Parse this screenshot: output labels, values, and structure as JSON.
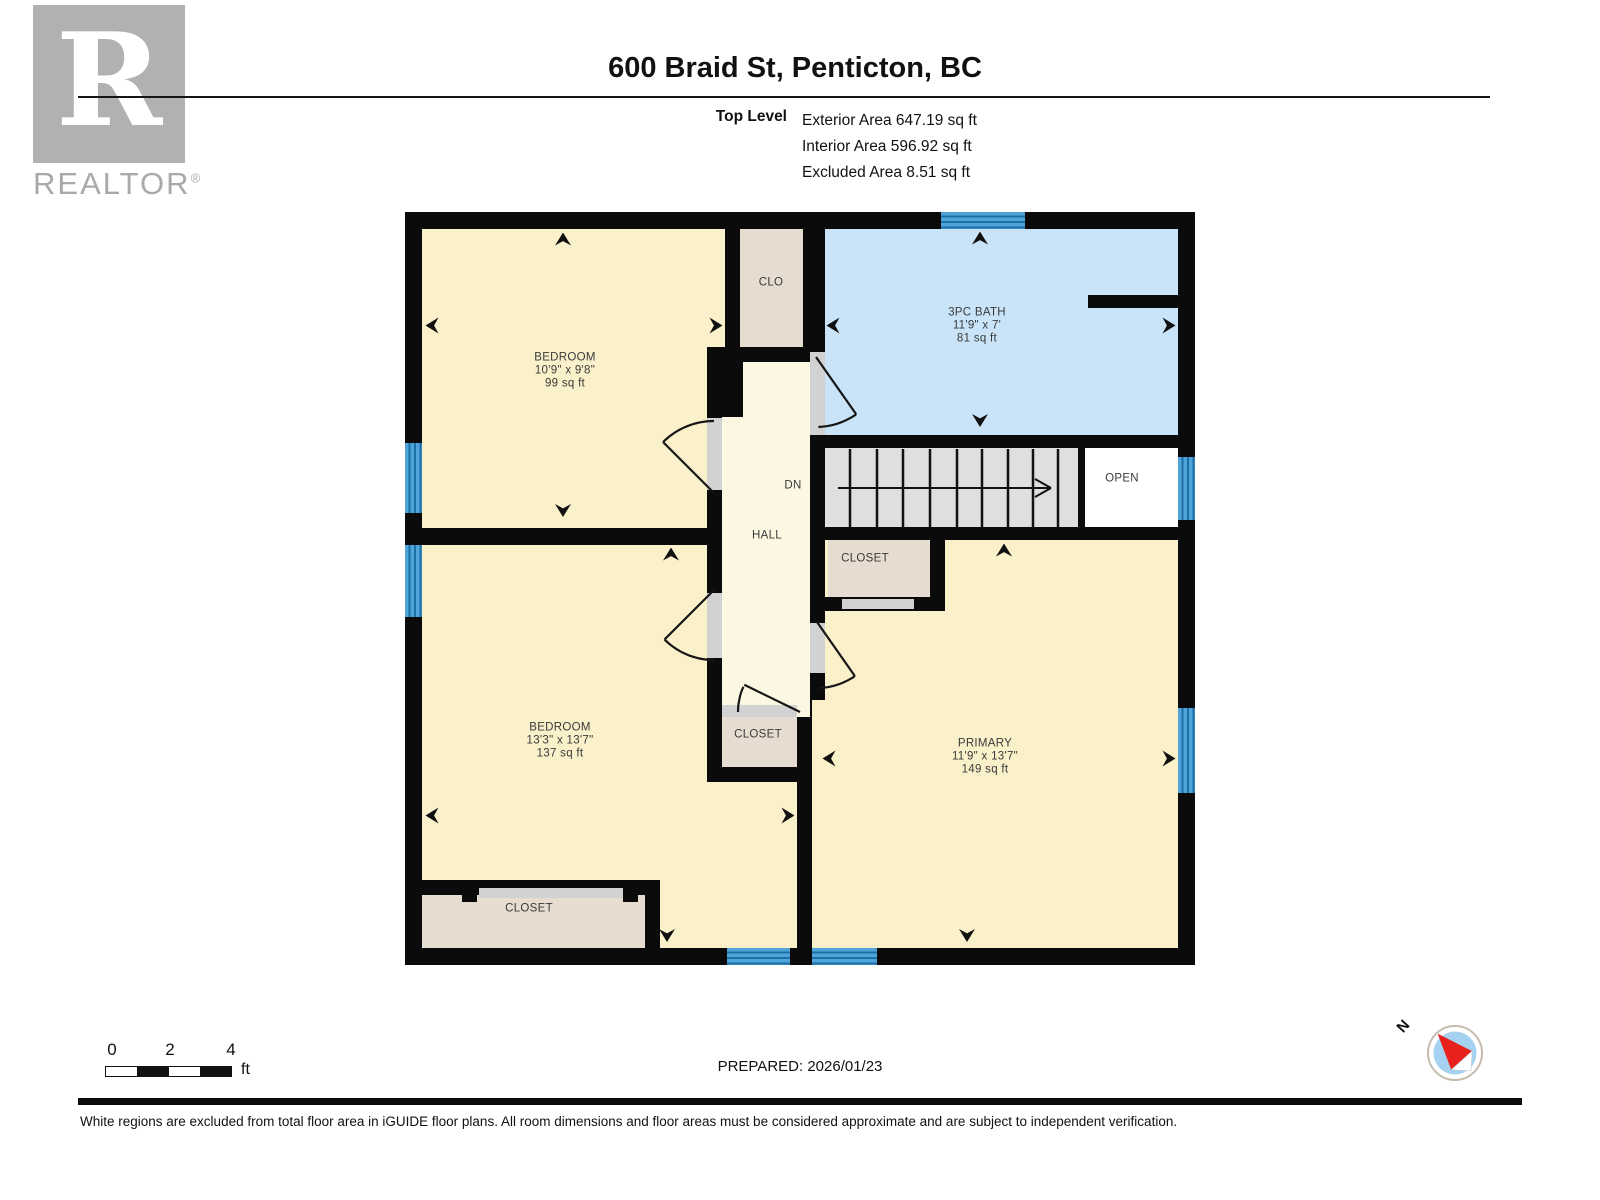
{
  "header": {
    "title": "600 Braid St, Penticton, BC",
    "level_label": "Top Level",
    "stats": [
      "Exterior Area 647.19 sq ft",
      "Interior Area 596.92 sq ft",
      "Excluded Area 8.51 sq ft"
    ]
  },
  "branding": {
    "logo_letter": "R",
    "logo_text": "REALTOR",
    "registered": "®"
  },
  "rooms": [
    {
      "name": "BEDROOM",
      "dims": "10'9\" x 9'8\"",
      "area": "99 sq ft"
    },
    {
      "name": "3PC BATH",
      "dims": "11'9\" x 7'",
      "area": "81 sq ft"
    },
    {
      "name": "BEDROOM",
      "dims": "13'3\" x 13'7\"",
      "area": "137 sq ft"
    },
    {
      "name": "PRIMARY",
      "dims": "11'9\" x 13'7\"",
      "area": "149 sq ft"
    }
  ],
  "labels": {
    "clo": "CLO",
    "dn": "DN",
    "hall": "HALL",
    "open": "OPEN",
    "closet_under_stairs": "CLOSET",
    "closet_hall": "CLOSET",
    "closet_bedroom": "CLOSET"
  },
  "scale": {
    "ticks": [
      "0",
      "2",
      "4"
    ],
    "unit": "ft"
  },
  "footer": {
    "prepared": "PREPARED: 2026/01/23",
    "disclaimer": "White regions are excluded from total floor area in iGUIDE floor plans. All room dimensions and floor areas must be considered approximate and are subject to independent verification."
  },
  "compass": {
    "north": "N"
  },
  "colors": {
    "wall": "#0b0b0b",
    "room_fill": "#faf0ca",
    "hall_fill": "#fcf7e3",
    "bath_fill": "#c9e4f8",
    "closet_fill": "#e6ddd0",
    "stairs_fill": "#dfdfdf",
    "window_blue": "#4fa5d8",
    "window_stripe": "#1e6fa9",
    "compass_red": "#e8211d"
  }
}
